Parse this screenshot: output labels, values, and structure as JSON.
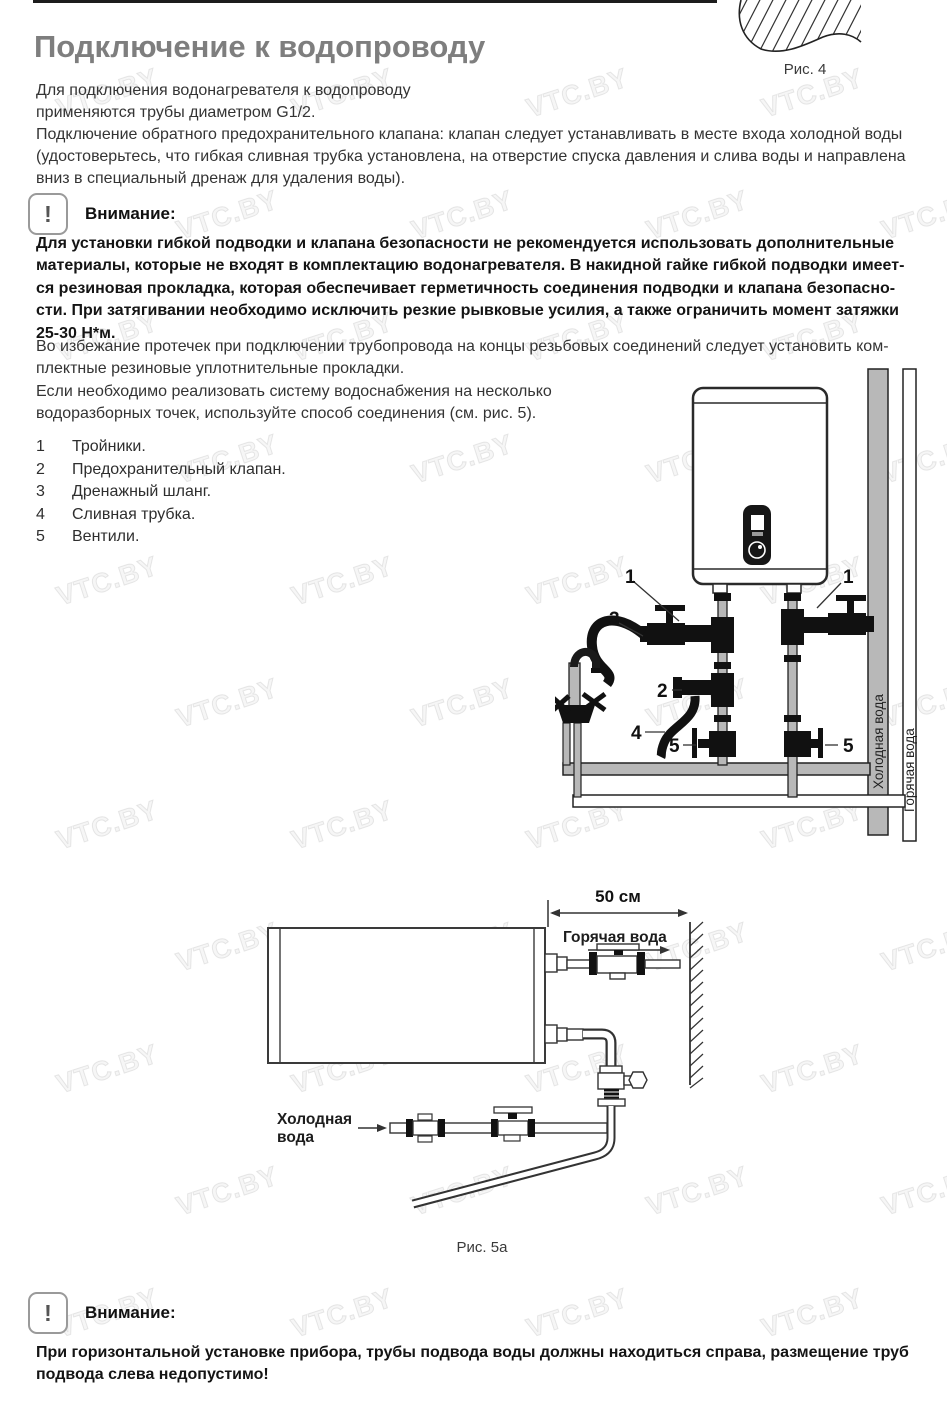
{
  "watermark": {
    "text": "VTC.BY"
  },
  "header": {
    "title": "Подключение к водопроводу"
  },
  "fig4": {
    "caption": "Рис. 4"
  },
  "intro": {
    "text": "Для подключения водонагревателя к водопроводу\nприменяются трубы диаметром G1/2.\nПодключение обратного предохранительного клапана: клапан следует устанавливать в месте входа холодной воды\n(удостоверьтесь, что гибкая сливная трубка установлена, на отверстие спуска давления и слива воды и направлена\nвниз в специальный дренаж для удаления воды)."
  },
  "warning1": {
    "icon": "!",
    "label": "Внимание:",
    "bold_text": "Для установки гибкой подводки и клапана безопасности не рекомендуется использовать дополнительные\nматериалы, которые не входят в комплектацию водонагревателя. В накидной гайке гибкой подводки имеет-\nся резиновая прокладка, которая обеспечивает герметичность соединения подводки и клапана безопасно-\nсти. При затягивании необходимо исключить резкие рывковые усилия, а также ограничить момент затяжки\n25-30 Н*м."
  },
  "para_leaks": {
    "text": "Во избежание протечек при подключении трубопровода на концы резьбовых соединений следует установить ком-\nплектные резиновые уплотнительные прокладки."
  },
  "para_multi": {
    "text": "Если необходимо реализовать систему водоснабжения на несколько\nводоразборных точек, используйте способ соединения (см. рис. 5)."
  },
  "legend": {
    "items": [
      {
        "num": "1",
        "label": "Тройники."
      },
      {
        "num": "2",
        "label": "Предохранительный клапан."
      },
      {
        "num": "3",
        "label": "Дренажный шланг."
      },
      {
        "num": "4",
        "label": "Сливная трубка."
      },
      {
        "num": "5",
        "label": "Вентили."
      }
    ]
  },
  "fig5": {
    "cold_pipe_label": "Холодная вода",
    "hot_pipe_label": "Горячая вода",
    "callouts": {
      "one_left": "1",
      "one_right": "1",
      "two": "2",
      "three": "3",
      "four": "4",
      "five_left": "5",
      "five_right": "5"
    }
  },
  "fig5a": {
    "dimension": "50 см",
    "hot_label": "Горячая вода",
    "cold_label_line1": "Холодная",
    "cold_label_line2": "вода",
    "caption": "Рис. 5а"
  },
  "warning2": {
    "icon": "!",
    "label": "Внимание:",
    "bold_text": "При горизонтальной установке прибора, трубы подвода воды должны находиться справа, размещение труб\nподвода слева недопустимо!"
  }
}
